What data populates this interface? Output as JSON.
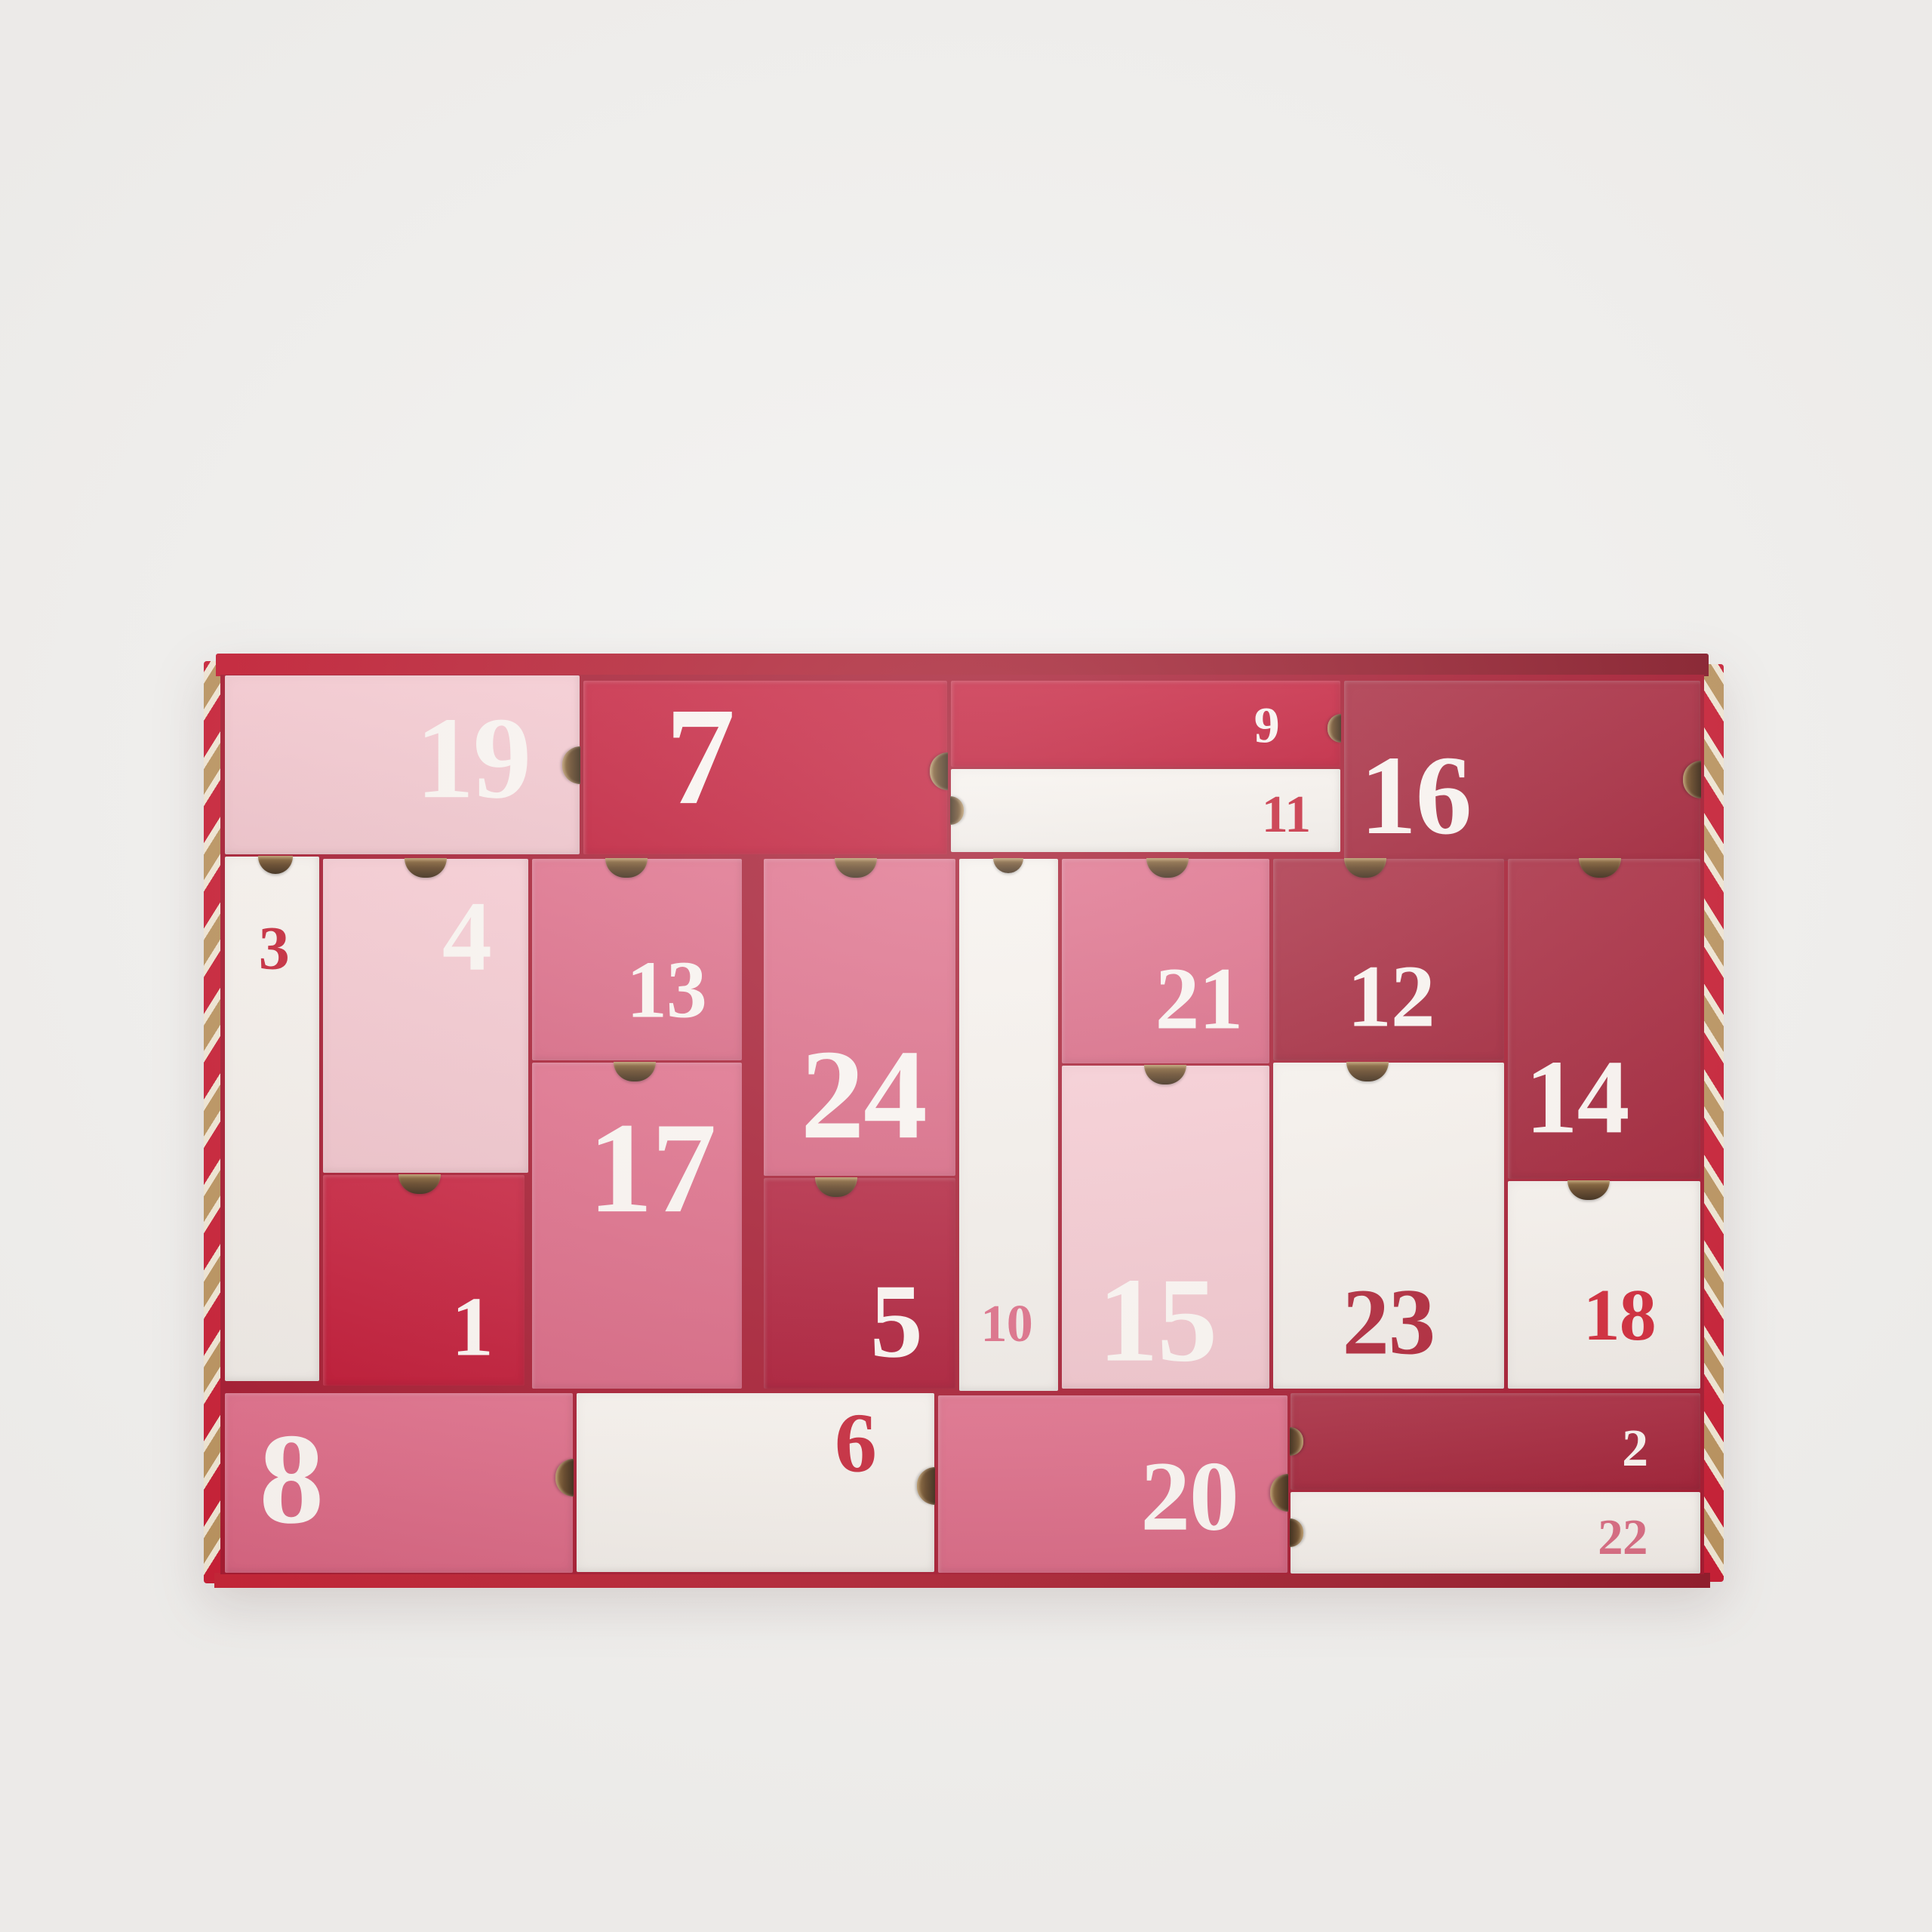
{
  "scene": {
    "background_color": "#f2f1ef",
    "tray": {
      "top_band_gradient_left": "#c2152c",
      "top_band_gradient_right": "#801120",
      "bottom_rim_gradient_left": "#c41e31",
      "bottom_rim_gradient_right": "#8f1626",
      "gap_color": "#a2132a",
      "stripe_red": "#c6182f",
      "stripe_gold": "#b8905a",
      "stripe_cream": "#f0e6d3"
    },
    "palette": {
      "light_pink": "#f5c6ce",
      "pink": "#dc6280",
      "red": "#c20f2e",
      "dark_red": "#a31c33",
      "deep_red": "#ab0e2c",
      "white": "#f6f1ec",
      "num_white": "#f9f4f0",
      "num_red": "#c31f33",
      "num_dark_red": "#ab1c30",
      "num_bright_red": "#cf2132",
      "num_pink": "#d9647f",
      "num_rose": "#d6677e"
    },
    "boxes": [
      {
        "day": "19",
        "fill": "light_pink",
        "num_color": "num_white",
        "x": 0.3,
        "y": 0.1,
        "w": 23.9,
        "h": 19.9,
        "notch": {
          "side": "right",
          "pos": 50,
          "nw": 24,
          "nh": 50
        },
        "label": {
          "x": 70,
          "y": 49,
          "size": 155
        }
      },
      {
        "day": "7",
        "fill": "red",
        "num_color": "num_white",
        "x": 24.45,
        "y": 0.7,
        "w": 24.55,
        "h": 19.3,
        "notch": {
          "side": "right",
          "pos": 52,
          "nw": 24,
          "nh": 50
        },
        "label": {
          "x": 32,
          "y": 47,
          "size": 185
        }
      },
      {
        "day": "9",
        "fill": "red",
        "num_color": "num_white",
        "x": 49.25,
        "y": 0.7,
        "w": 26.25,
        "h": 9.5,
        "notch": {
          "side": "right",
          "pos": 55,
          "nw": 18,
          "nh": 38
        },
        "label": {
          "x": 81,
          "y": 54,
          "size": 68
        }
      },
      {
        "day": "11",
        "fill": "white",
        "num_color": "num_red",
        "x": 49.25,
        "y": 10.45,
        "w": 26.25,
        "h": 9.25,
        "notch": {
          "side": "left",
          "pos": 50,
          "nw": 18,
          "nh": 38
        },
        "label": {
          "x": 86,
          "y": 58,
          "size": 70
        }
      },
      {
        "day": "16",
        "fill": "dark_red",
        "num_color": "num_white",
        "x": 75.75,
        "y": 0.7,
        "w": 24.0,
        "h": 20.0,
        "notch": {
          "side": "right",
          "pos": 55,
          "nw": 24,
          "nh": 50
        },
        "label": {
          "x": 20,
          "y": 66,
          "size": 150
        }
      },
      {
        "day": "3",
        "fill": "white",
        "num_color": "num_red",
        "x": 0.3,
        "y": 20.25,
        "w": 6.35,
        "h": 58.3,
        "notch": {
          "side": "top",
          "pos": 54,
          "nw": 46,
          "nh": 24
        },
        "label": {
          "x": 52,
          "y": 18,
          "size": 82
        }
      },
      {
        "day": "4",
        "fill": "light_pink",
        "num_color": "num_white",
        "x": 6.9,
        "y": 20.45,
        "w": 13.85,
        "h": 34.95,
        "notch": {
          "side": "top",
          "pos": 50,
          "nw": 56,
          "nh": 26
        },
        "label": {
          "x": 70,
          "y": 26,
          "size": 132
        }
      },
      {
        "day": "1",
        "fill": "red",
        "num_color": "num_white",
        "x": 6.9,
        "y": 55.65,
        "w": 13.6,
        "h": 23.35,
        "notch": {
          "side": "top",
          "pos": 48,
          "nw": 56,
          "nh": 26
        },
        "label": {
          "x": 74,
          "y": 74,
          "size": 112
        }
      },
      {
        "day": "13",
        "fill": "pink",
        "num_color": "num_white",
        "x": 21.0,
        "y": 20.45,
        "w": 14.15,
        "h": 22.45,
        "notch": {
          "side": "top",
          "pos": 45,
          "nw": 56,
          "nh": 26
        },
        "label": {
          "x": 64,
          "y": 67,
          "size": 108
        }
      },
      {
        "day": "17",
        "fill": "pink",
        "num_color": "num_white",
        "x": 21.0,
        "y": 43.15,
        "w": 14.15,
        "h": 36.25,
        "notch": {
          "side": "top",
          "pos": 49,
          "nw": 56,
          "nh": 26
        },
        "label": {
          "x": 57,
          "y": 34,
          "size": 172
        }
      },
      {
        "day": "24",
        "fill": "pink",
        "num_color": "num_white",
        "x": 36.6,
        "y": 20.45,
        "w": 12.95,
        "h": 35.25,
        "notch": {
          "side": "top",
          "pos": 48,
          "nw": 56,
          "nh": 26
        },
        "label": {
          "x": 52,
          "y": 76,
          "size": 170
        }
      },
      {
        "day": "5",
        "fill": "deep_red",
        "num_color": "num_white",
        "x": 36.6,
        "y": 55.95,
        "w": 12.95,
        "h": 23.45,
        "notch": {
          "side": "top",
          "pos": 38,
          "nw": 56,
          "nh": 26
        },
        "label": {
          "x": 69,
          "y": 70,
          "size": 140
        }
      },
      {
        "day": "10",
        "fill": "white",
        "num_color": "num_pink",
        "x": 49.8,
        "y": 20.45,
        "w": 6.65,
        "h": 59.15,
        "notch": {
          "side": "top",
          "pos": 50,
          "nw": 40,
          "nh": 20
        },
        "label": {
          "x": 48,
          "y": 88,
          "size": 70
        }
      },
      {
        "day": "21",
        "fill": "pink",
        "num_color": "num_white",
        "x": 56.7,
        "y": 20.45,
        "w": 14.0,
        "h": 22.75,
        "notch": {
          "side": "top",
          "pos": 51,
          "nw": 56,
          "nh": 26
        },
        "label": {
          "x": 66,
          "y": 70,
          "size": 118
        }
      },
      {
        "day": "15",
        "fill": "light_pink",
        "num_color": "num_white",
        "x": 56.7,
        "y": 43.45,
        "w": 14.0,
        "h": 35.95,
        "notch": {
          "side": "top",
          "pos": 50,
          "nw": 56,
          "nh": 26
        },
        "label": {
          "x": 46,
          "y": 80,
          "size": 160
        }
      },
      {
        "day": "12",
        "fill": "dark_red",
        "num_color": "num_white",
        "x": 70.95,
        "y": 20.45,
        "w": 15.55,
        "h": 22.45,
        "notch": {
          "side": "top",
          "pos": 40,
          "nw": 56,
          "nh": 26
        },
        "label": {
          "x": 51,
          "y": 70,
          "size": 118
        }
      },
      {
        "day": "23",
        "fill": "white",
        "num_color": "num_dark_red",
        "x": 70.95,
        "y": 43.15,
        "w": 15.55,
        "h": 36.25,
        "notch": {
          "side": "top",
          "pos": 41,
          "nw": 56,
          "nh": 26
        },
        "label": {
          "x": 50,
          "y": 81,
          "size": 125
        }
      },
      {
        "day": "14",
        "fill": "dark_red",
        "num_color": "num_white",
        "x": 86.75,
        "y": 20.45,
        "w": 13.0,
        "h": 35.55,
        "notch": {
          "side": "top",
          "pos": 48,
          "nw": 56,
          "nh": 26
        },
        "label": {
          "x": 36,
          "y": 76,
          "size": 140
        }
      },
      {
        "day": "18",
        "fill": "white",
        "num_color": "num_bright_red",
        "x": 86.75,
        "y": 56.25,
        "w": 13.0,
        "h": 23.15,
        "notch": {
          "side": "top",
          "pos": 42,
          "nw": 56,
          "nh": 26
        },
        "label": {
          "x": 58,
          "y": 66,
          "size": 98
        }
      },
      {
        "day": "8",
        "fill": "pink",
        "num_color": "num_white",
        "x": 0.3,
        "y": 79.85,
        "w": 23.45,
        "h": 20.0,
        "notch": {
          "side": "right",
          "pos": 47,
          "nw": 24,
          "nh": 50
        },
        "label": {
          "x": 19,
          "y": 51,
          "size": 172
        }
      },
      {
        "day": "6",
        "fill": "white",
        "num_color": "num_red",
        "x": 24.0,
        "y": 79.85,
        "w": 24.1,
        "h": 19.9,
        "notch": {
          "side": "right",
          "pos": 52,
          "nw": 24,
          "nh": 50
        },
        "label": {
          "x": 78,
          "y": 30,
          "size": 112
        }
      },
      {
        "day": "20",
        "fill": "pink",
        "num_color": "num_white",
        "x": 48.35,
        "y": 80.1,
        "w": 23.55,
        "h": 19.75,
        "notch": {
          "side": "right",
          "pos": 55,
          "nw": 24,
          "nh": 50
        },
        "label": {
          "x": 72,
          "y": 59,
          "size": 132
        }
      },
      {
        "day": "2",
        "fill": "dark_red",
        "num_color": "num_white",
        "x": 72.15,
        "y": 79.85,
        "w": 27.6,
        "h": 10.75,
        "notch": {
          "side": "left",
          "pos": 50,
          "nw": 18,
          "nh": 38
        },
        "label": {
          "x": 84,
          "y": 60,
          "size": 70
        }
      },
      {
        "day": "22",
        "fill": "white",
        "num_color": "num_rose",
        "x": 72.15,
        "y": 90.85,
        "w": 27.6,
        "h": 9.1,
        "notch": {
          "side": "left",
          "pos": 50,
          "nw": 18,
          "nh": 38
        },
        "label": {
          "x": 81,
          "y": 58,
          "size": 67
        }
      }
    ]
  }
}
